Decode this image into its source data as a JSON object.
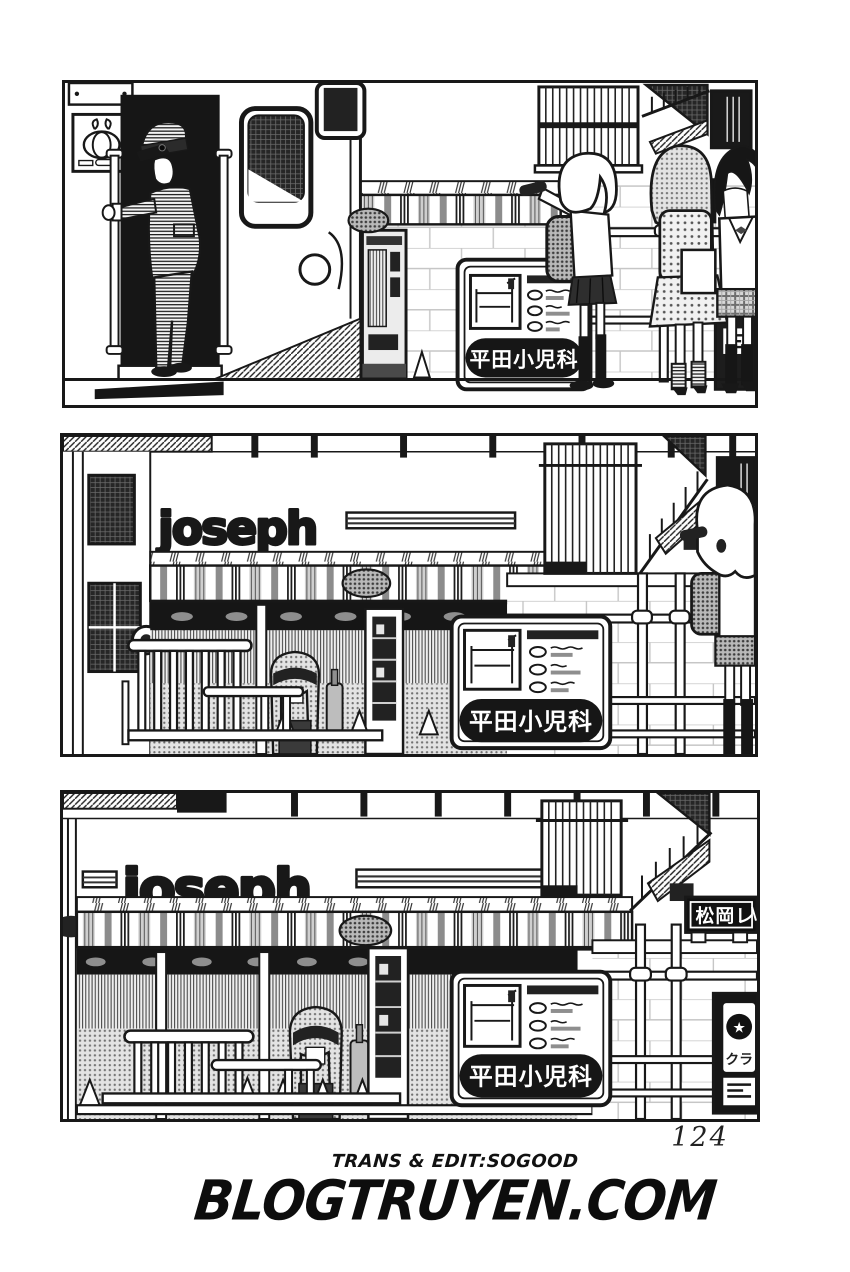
{
  "page": {
    "number": "124",
    "credits": "TRANS & EDIT:SOGOOD",
    "site": "BLOGTRUYEN.COM"
  },
  "signs": {
    "pediatrics": "平田小児科",
    "shop_logo": "joseph",
    "matsuoka": "松岡レ",
    "club": "クラ",
    "star_icon": "★"
  },
  "colors": {
    "ink": "#181818",
    "paper": "#ffffff",
    "halftone_gray": "#8e8e8e"
  }
}
